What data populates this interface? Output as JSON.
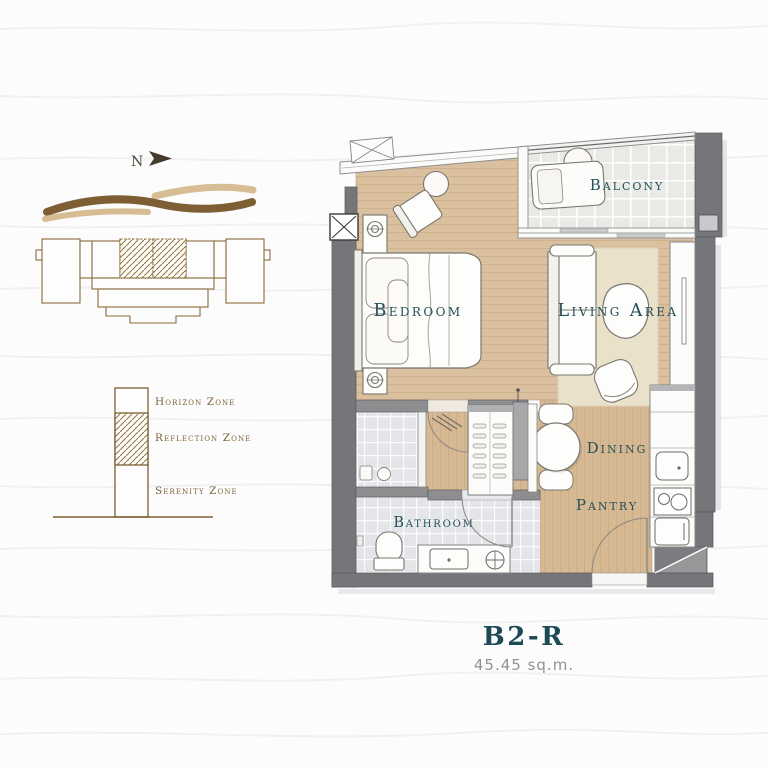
{
  "compass": {
    "label": "N"
  },
  "unit": {
    "name": "B2-R",
    "area": "45.45 sq.m."
  },
  "rooms": {
    "bedroom": "Bedroom",
    "living_area": "Living Area",
    "balcony": "Balcony",
    "dining": "Dining",
    "pantry": "Pantry",
    "bathroom": "Bathroom"
  },
  "zones": {
    "horizon": "Horizon Zone",
    "reflection": "Reflection Zone",
    "serenity": "Serenity Zone"
  },
  "colors": {
    "label_teal": "#24505A",
    "title_teal": "#1D4B54",
    "area_gray": "#8D9396",
    "zone_brown": "#7D5F33",
    "wave_tan": "#D7BD94",
    "wave_brown": "#7D5F33",
    "wood_floor": "#D8BC9B",
    "wall_dark": "#76767A",
    "balcony_tile": "#E9E9E6",
    "bathroom_tile": "#E4E5E8"
  }
}
